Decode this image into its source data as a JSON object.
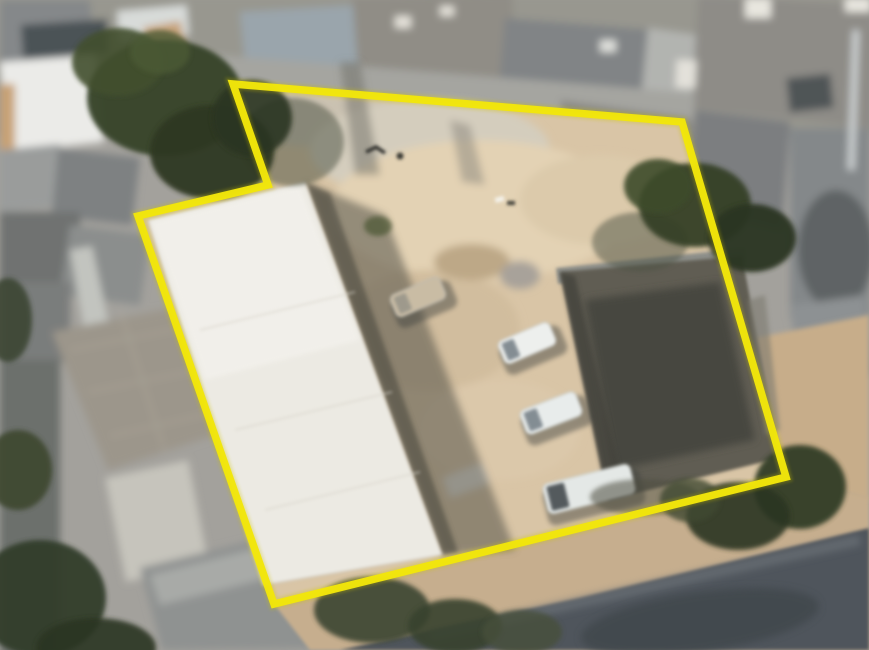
{
  "app": {
    "title": "Satellite aerial view of a property lot outlined with a yellow boundary",
    "view_type": "satellite-photo"
  },
  "boundary": {
    "shape": "polygon",
    "vertex_count": 6,
    "points": "233,84 682,122 786,477 274,604 138,216 268,185",
    "color": "#f2e60a",
    "glow_color": "#cfc400",
    "stroke_width": 7.5
  },
  "colors": {
    "background_gray": "#a3a19c",
    "sand": "#d9c5a6",
    "warehouse_roof": "#eceae3",
    "shadow": "#55534a",
    "dark_building": "#615d53",
    "road": "#4f555b",
    "sidewalk": "#c6ae8e",
    "dirt_path": "#c7ad8a",
    "tree": "#333d27"
  },
  "objects": {
    "warehouse": {
      "label": "large white-roofed warehouse inside lot",
      "points": "148,220 305,182 442,555 263,585",
      "shadow_points": "305,182 385,215 515,550 442,555"
    },
    "dark_building": {
      "label": "dark-roofed building inside lot",
      "points": "560,272 742,256 780,458 608,500",
      "wall_points": "556,268 744,248 746,262 558,284"
    },
    "road": {
      "label": "street at bottom right",
      "points": "340,650 580,598 869,528 869,650"
    },
    "sidewalk": {
      "label": "sidewalk strip along boundary",
      "points": "274,604 786,477 869,497 869,650 310,650"
    },
    "dirt_path": {
      "label": "dirt path right of lot",
      "points": "745,340 869,315 869,500 786,477"
    },
    "vehicles": [
      {
        "label": "parked-car-beige",
        "cx": 418,
        "cy": 297,
        "w": 54,
        "h": 24,
        "angle": -23,
        "body": "#c9bca4",
        "cab": "#9a968a",
        "cab_w": 13
      },
      {
        "label": "parked-car-white-1",
        "cx": 527,
        "cy": 343,
        "w": 56,
        "h": 25,
        "angle": -23,
        "body": "#edefed",
        "cab": "#79838a",
        "cab_w": 13
      },
      {
        "label": "parked-car-white-2",
        "cx": 551,
        "cy": 413,
        "w": 60,
        "h": 26,
        "angle": -21,
        "body": "#e8eceb",
        "cab": "#79838a",
        "cab_w": 14
      },
      {
        "label": "parked-van-white",
        "cx": 589,
        "cy": 489,
        "w": 90,
        "h": 31,
        "angle": -14,
        "body": "#e4e8e6",
        "cab": "#454c50",
        "cab_w": 18
      }
    ],
    "trees": [
      {
        "cx": 292,
        "cy": 142,
        "rx": 52,
        "ry": 44,
        "fill": "#4a5040",
        "opacity": 0.5
      },
      {
        "cx": 640,
        "cy": 242,
        "rx": 48,
        "ry": 30,
        "fill": "#4e5244",
        "opacity": 0.5
      },
      {
        "cx": 645,
        "cy": 497,
        "rx": 55,
        "ry": 18,
        "fill": "#4d4e41",
        "opacity": 0.55
      },
      {
        "cx": 165,
        "cy": 98,
        "rx": 78,
        "ry": 58,
        "fill": "#39442c",
        "opacity": 0.97
      },
      {
        "cx": 212,
        "cy": 152,
        "rx": 62,
        "ry": 47,
        "fill": "#2e3823",
        "opacity": 0.95
      },
      {
        "cx": 118,
        "cy": 62,
        "rx": 46,
        "ry": 34,
        "fill": "#42502f",
        "opacity": 0.9
      },
      {
        "cx": 252,
        "cy": 118,
        "rx": 40,
        "ry": 38,
        "fill": "#2a3420",
        "opacity": 0.9
      },
      {
        "cx": 160,
        "cy": 52,
        "rx": 30,
        "ry": 22,
        "fill": "#4c5a34",
        "opacity": 0.8
      },
      {
        "cx": 695,
        "cy": 205,
        "rx": 56,
        "ry": 42,
        "fill": "#343f27",
        "opacity": 0.95
      },
      {
        "cx": 752,
        "cy": 238,
        "rx": 44,
        "ry": 34,
        "fill": "#2c3622",
        "opacity": 0.95
      },
      {
        "cx": 658,
        "cy": 186,
        "rx": 34,
        "ry": 27,
        "fill": "#3d4b2c",
        "opacity": 0.9
      },
      {
        "cx": 800,
        "cy": 487,
        "rx": 46,
        "ry": 42,
        "fill": "#333d28",
        "opacity": 0.95
      },
      {
        "cx": 738,
        "cy": 516,
        "rx": 52,
        "ry": 34,
        "fill": "#2b3522",
        "opacity": 0.9
      },
      {
        "cx": 690,
        "cy": 500,
        "rx": 30,
        "ry": 22,
        "fill": "#3f4a30",
        "opacity": 0.8
      },
      {
        "cx": 372,
        "cy": 610,
        "rx": 58,
        "ry": 33,
        "fill": "#3a4430",
        "opacity": 0.9
      },
      {
        "cx": 455,
        "cy": 626,
        "rx": 47,
        "ry": 27,
        "fill": "#39432e",
        "opacity": 0.9
      },
      {
        "cx": 522,
        "cy": 632,
        "rx": 40,
        "ry": 22,
        "fill": "#47503b",
        "opacity": 0.8
      },
      {
        "cx": 40,
        "cy": 598,
        "rx": 66,
        "ry": 58,
        "fill": "#333c2a",
        "opacity": 0.95
      },
      {
        "cx": 96,
        "cy": 648,
        "rx": 60,
        "ry": 30,
        "fill": "#2c3424",
        "opacity": 0.9
      },
      {
        "cx": 18,
        "cy": 470,
        "rx": 34,
        "ry": 40,
        "fill": "#3c462f",
        "opacity": 0.9
      },
      {
        "cx": 8,
        "cy": 320,
        "rx": 24,
        "ry": 42,
        "fill": "#39432d",
        "opacity": 0.85
      },
      {
        "cx": 378,
        "cy": 226,
        "rx": 14,
        "ry": 10,
        "fill": "#4a5531",
        "opacity": 0.7
      }
    ]
  }
}
